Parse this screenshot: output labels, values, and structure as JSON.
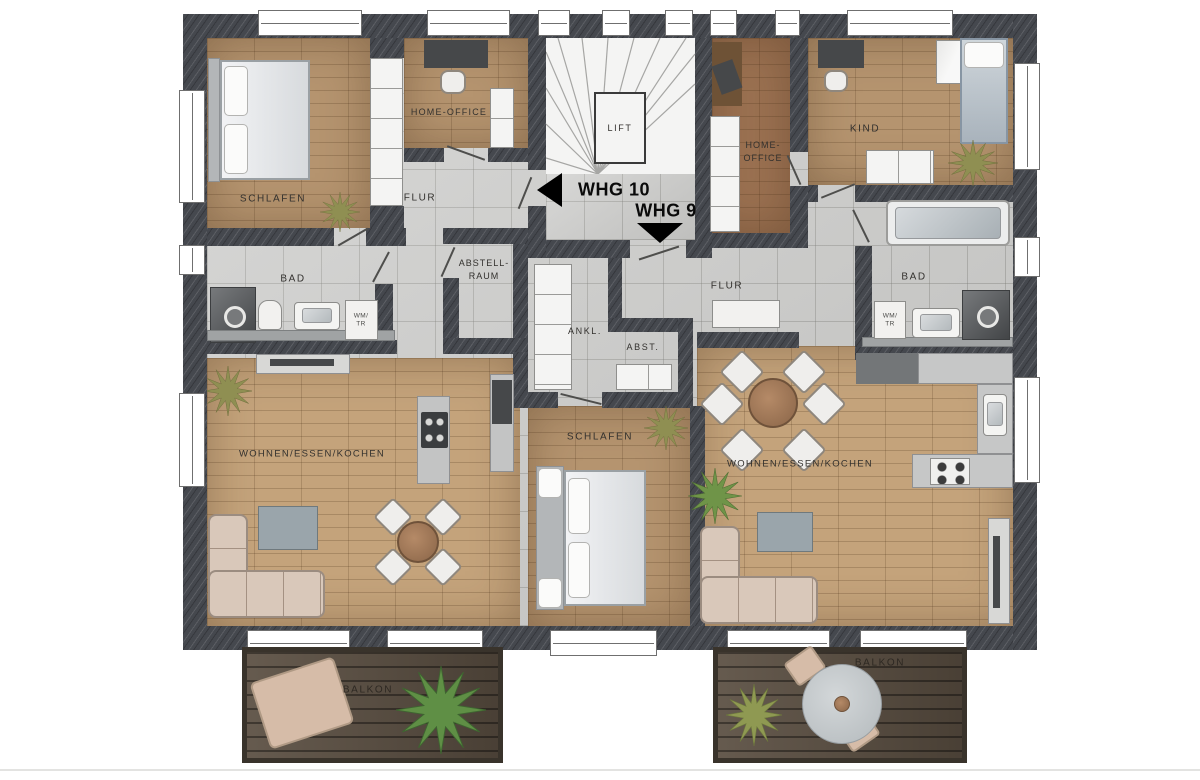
{
  "plan": {
    "title": "Obergeschoss Grundriss WHG 9 / WHG 10",
    "apartments": [
      {
        "name": "WHG 10",
        "arrow": "left"
      },
      {
        "name": "WHG 9",
        "arrow": "down"
      }
    ],
    "labels": {
      "lift": "LIFT",
      "schlafen_whg10": "SCHLAFEN",
      "homeoffice_whg10": "HOME-OFFICE",
      "flur_whg10": "FLUR",
      "bad_whg10": "BAD",
      "abstellraum_line1": "ABSTELL-",
      "abstellraum_line2": "RAUM",
      "wohnen_whg10": "WOHNEN/ESSEN/KOCHEN",
      "balkon_whg10": "BALKON",
      "homeoffice_whg9_line1": "HOME-",
      "homeoffice_whg9_line2": "OFFICE",
      "kind_whg9": "KIND",
      "flur_whg9": "FLUR",
      "bad_whg9": "BAD",
      "ankl_whg9": "ANKL.",
      "abst_whg9": "ABST.",
      "schlafen_whg9": "SCHLAFEN",
      "wohnen_whg9": "WOHNEN/ESSEN/KOCHEN",
      "balkon_whg9": "BALKON",
      "wm_tr_line1": "WM/",
      "wm_tr_line2": "TR"
    },
    "colors": {
      "wall": "#45484e",
      "tile_floor": "#cbcbc9",
      "wood_light": "#c4a37b",
      "wood_mid": "#b5946f",
      "wood_red": "#9c7252",
      "balcony_deck": "#5a4e41",
      "label_text": "#33312e",
      "arrow_black": "#000000"
    }
  }
}
